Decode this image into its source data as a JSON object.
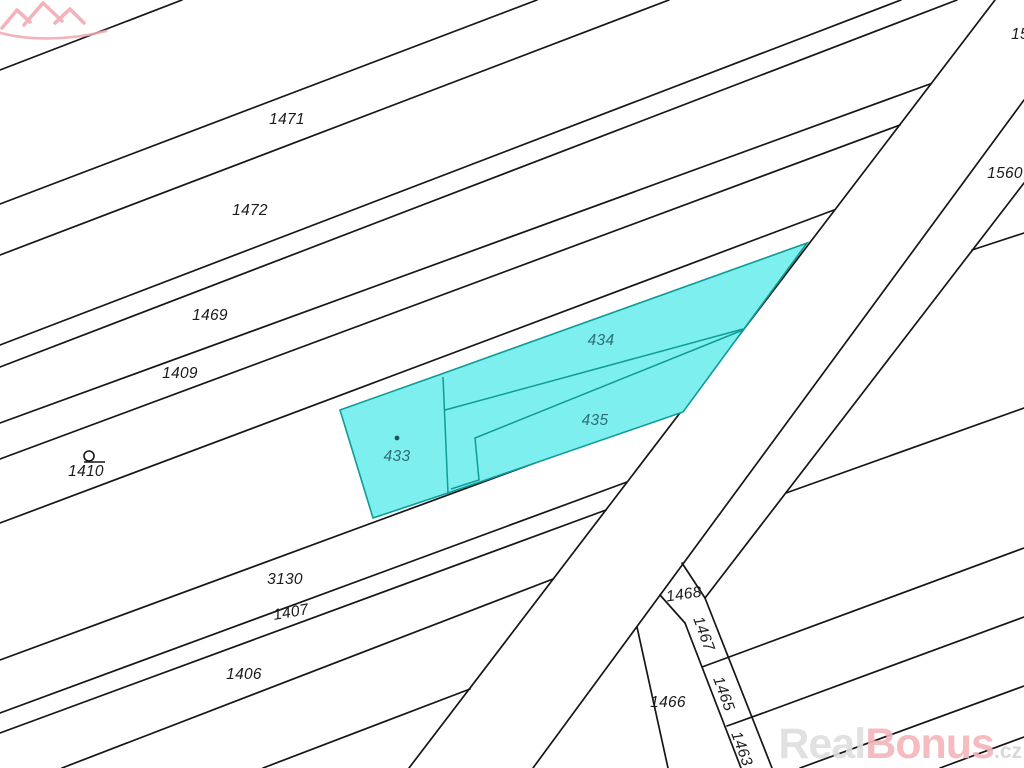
{
  "map": {
    "type": "cadastral-map",
    "background": "#ffffff",
    "boundary_line_color": "#161616",
    "highlight": {
      "fill": "#7defef",
      "stroke": "#0f9b97",
      "label_color": "#2e6e74",
      "selected_parcels": [
        "433",
        "434",
        "435"
      ]
    },
    "parcel_labels": [
      {
        "text": "1471",
        "x": 287,
        "y": 120,
        "rot": 0,
        "kind": "normal"
      },
      {
        "text": "1472",
        "x": 250,
        "y": 211,
        "rot": 0,
        "kind": "normal"
      },
      {
        "text": "1469",
        "x": 210,
        "y": 316,
        "rot": 0,
        "kind": "normal"
      },
      {
        "text": "1409",
        "x": 180,
        "y": 374,
        "rot": 0,
        "kind": "normal"
      },
      {
        "text": "1410",
        "x": 86,
        "y": 472,
        "rot": 0,
        "kind": "normal"
      },
      {
        "text": "3130",
        "x": 285,
        "y": 580,
        "rot": 0,
        "kind": "normal"
      },
      {
        "text": "1407",
        "x": 291,
        "y": 613,
        "rot": -10,
        "kind": "normal"
      },
      {
        "text": "1406",
        "x": 244,
        "y": 675,
        "rot": 0,
        "kind": "normal"
      },
      {
        "text": "15",
        "x": 1020,
        "y": 35,
        "rot": 0,
        "kind": "normal"
      },
      {
        "text": "1560",
        "x": 1005,
        "y": 174,
        "rot": 0,
        "kind": "normal"
      },
      {
        "text": "1468",
        "x": 684,
        "y": 595,
        "rot": -8,
        "kind": "normal"
      },
      {
        "text": "1467",
        "x": 703,
        "y": 634,
        "rot": 70,
        "kind": "normal"
      },
      {
        "text": "1465",
        "x": 723,
        "y": 694,
        "rot": 70,
        "kind": "normal"
      },
      {
        "text": "1463",
        "x": 741,
        "y": 749,
        "rot": 70,
        "kind": "normal"
      },
      {
        "text": "1466",
        "x": 668,
        "y": 703,
        "rot": 0,
        "kind": "normal"
      },
      {
        "text": "433",
        "x": 397,
        "y": 457,
        "rot": 0,
        "kind": "highlight"
      },
      {
        "text": "434",
        "x": 601,
        "y": 341,
        "rot": 0,
        "kind": "highlight"
      },
      {
        "text": "435",
        "x": 595,
        "y": 421,
        "rot": 0,
        "kind": "highlight"
      }
    ],
    "symbols": [
      {
        "name": "landmark-circle-symbol",
        "x": 89,
        "y": 456
      },
      {
        "name": "parcel-433-point-marker",
        "x": 397,
        "y": 438
      }
    ],
    "watermark": {
      "text_real": "Real",
      "text_bonus": "Bonus",
      "text_tld": ".cz",
      "color_real": "#dededf",
      "color_bonus": "#f3b4ba",
      "color_tld": "#d4d4d6",
      "logo_color": "#f0a8ae"
    }
  }
}
